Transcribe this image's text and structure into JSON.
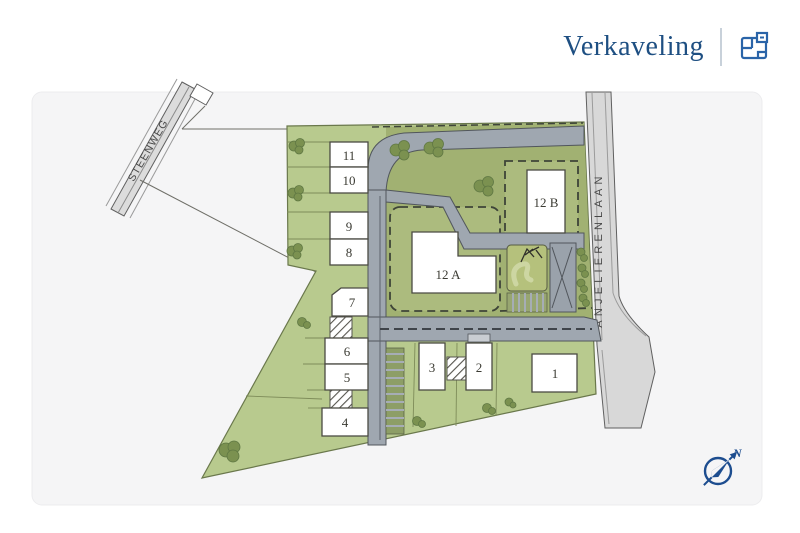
{
  "header": {
    "title": "Verkaveling"
  },
  "map": {
    "plots": [
      {
        "id": "1",
        "label": "1"
      },
      {
        "id": "2",
        "label": "2"
      },
      {
        "id": "3",
        "label": "3"
      },
      {
        "id": "4",
        "label": "4"
      },
      {
        "id": "5",
        "label": "5"
      },
      {
        "id": "6",
        "label": "6"
      },
      {
        "id": "7",
        "label": "7"
      },
      {
        "id": "8",
        "label": "8"
      },
      {
        "id": "9",
        "label": "9"
      },
      {
        "id": "10",
        "label": "10"
      },
      {
        "id": "11",
        "label": "11"
      },
      {
        "id": "12A",
        "label": "12 A"
      },
      {
        "id": "12B",
        "label": "12 B"
      }
    ],
    "streets": [
      {
        "name": "STEENWEG"
      },
      {
        "name": "ANJELIERENLAAN"
      }
    ],
    "compass": {
      "north_label": "N"
    }
  },
  "colors": {
    "accent_blue": "#1e4f82",
    "compass_blue": "#1d4d8f",
    "site_green_light": "#b8ca8e",
    "site_green_dark": "#a1b172",
    "parcel_green": "#acbb7e",
    "internal_road_gray": "#9fa7b0",
    "street_gray": "#d8d8d8",
    "card_background": "#f5f5f6"
  }
}
